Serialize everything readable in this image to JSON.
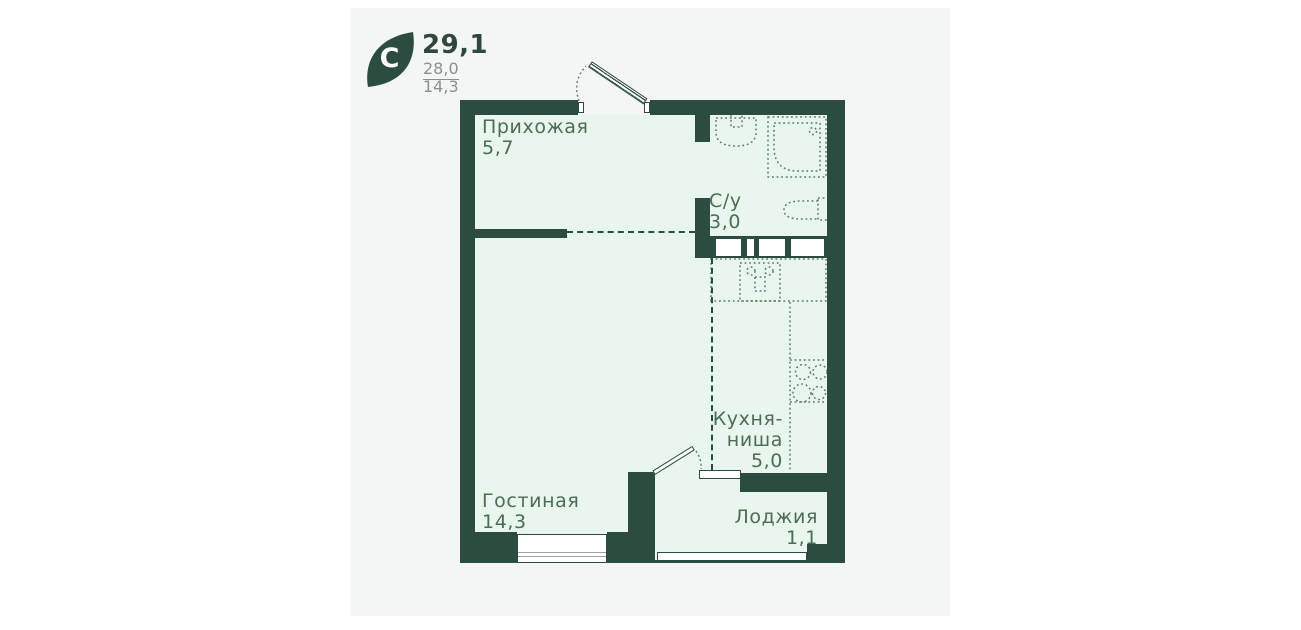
{
  "logo": {
    "letter": "С"
  },
  "stats": [
    "29,1",
    "28,0",
    "14,3"
  ],
  "rooms": {
    "hallway": {
      "name": "Прихожая",
      "area": "5,7"
    },
    "bathroom": {
      "name": "С/у",
      "area": "3,0"
    },
    "kitchen": {
      "name_line1": "Кухня-",
      "name_line2": "ниша",
      "area": "5,0"
    },
    "living": {
      "name": "Гостиная",
      "area": "14,3"
    },
    "loggia": {
      "name": "Лоджия",
      "area": "1,1"
    }
  },
  "colors": {
    "wall": "#2c4c3f",
    "room_fill": "#e9f6ee",
    "canvas_bg": "#f4f5f5",
    "label_text": "#4d6b5b",
    "muted_text": "#8b918d",
    "fixture_outline": "#5e7769"
  }
}
